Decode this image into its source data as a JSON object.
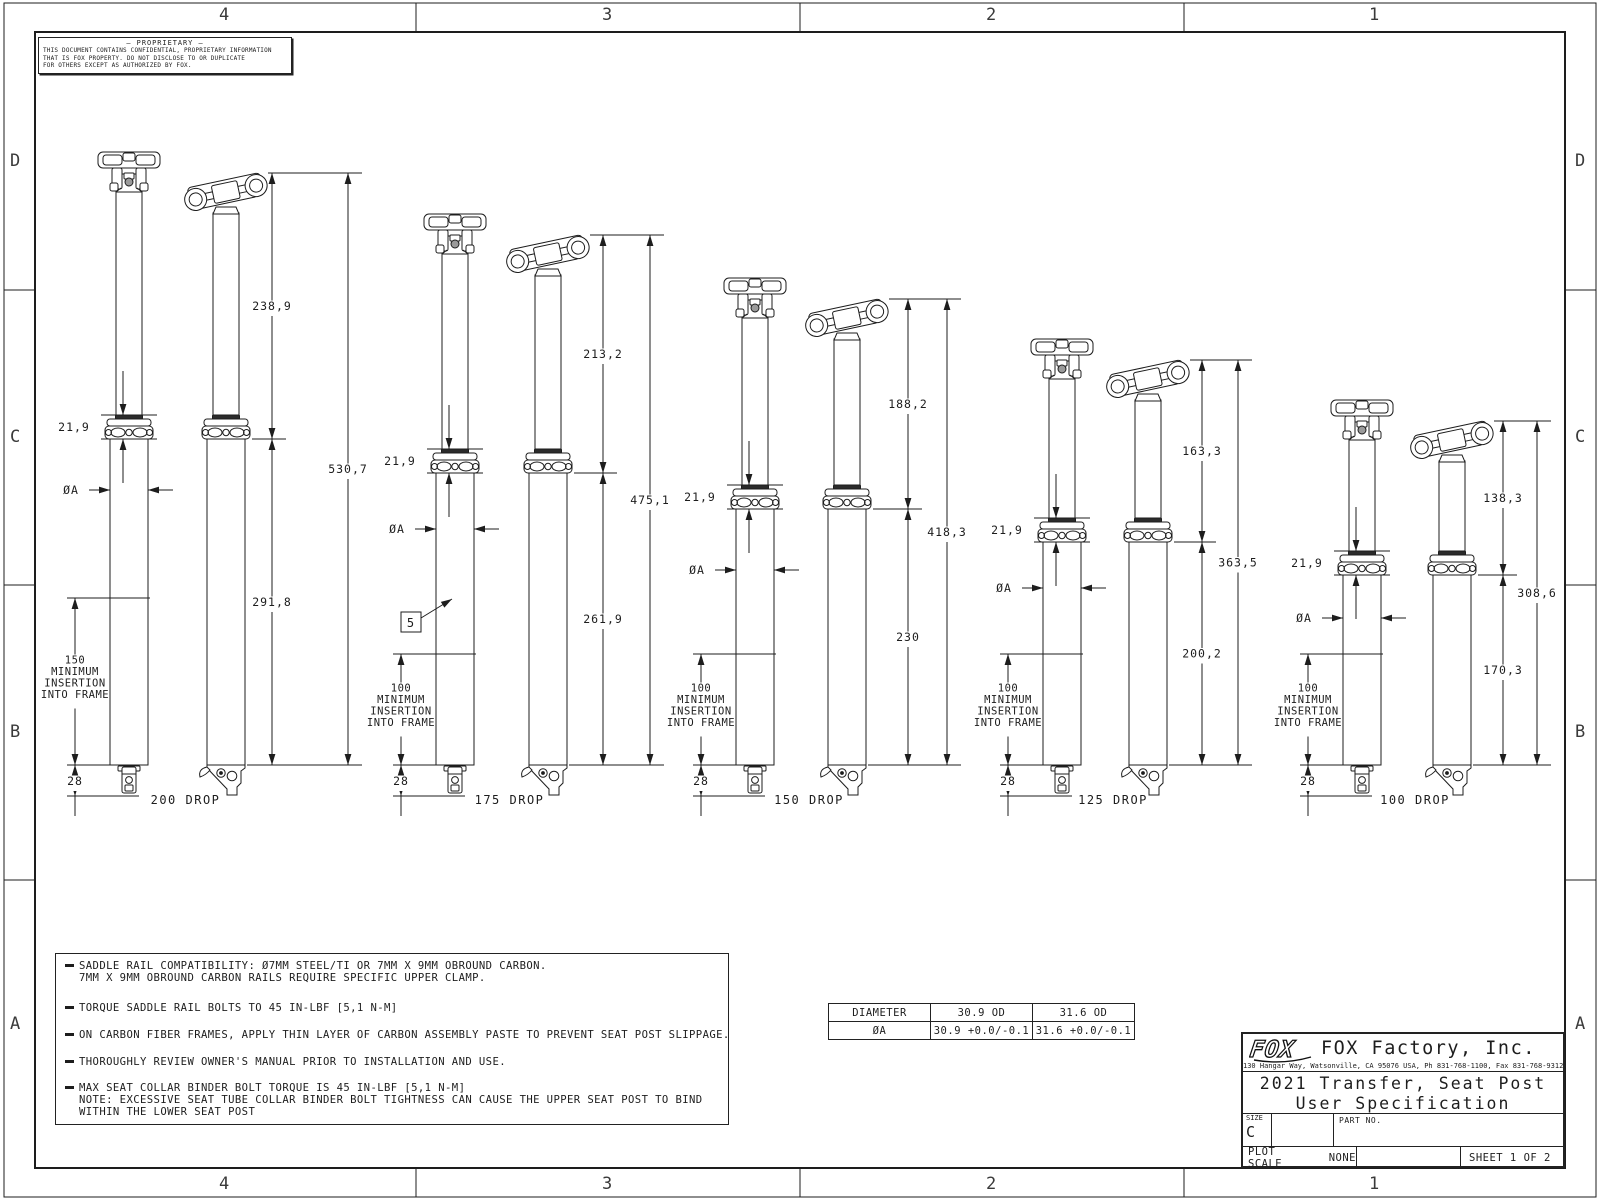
{
  "colors": {
    "line": "#1d1d1d",
    "background": "#ffffff"
  },
  "sheet": {
    "zones_top": [
      "4",
      "3",
      "2",
      "1"
    ],
    "zones_bottom": [
      "4",
      "3",
      "2",
      "1"
    ],
    "zones_left": [
      "D",
      "C",
      "B",
      "A"
    ],
    "zones_right": [
      "D",
      "C",
      "B",
      "A"
    ]
  },
  "proprietary": {
    "title": "—  PROPRIETARY  —",
    "line1": "THIS DOCUMENT CONTAINS CONFIDENTIAL, PROPRIETARY INFORMATION",
    "line2": "THAT IS FOX PROPERTY.  DO NOT DISCLOSE TO OR DUPLICATE",
    "line3": "FOR OTHERS EXCEPT AS AUTHORIZED BY FOX."
  },
  "drawing": {
    "baseline_y": 765,
    "px_per_mm": 1.115,
    "variants": [
      {
        "drop_label": "200 DROP",
        "cx_front": 129,
        "cx_side": 226,
        "chain_x": 272,
        "overall_x": 348,
        "dia_y": 490,
        "upper_mm": 238.9,
        "lower_mm": 291.8,
        "overall_mm": 530.7,
        "collar_mm": 21.9,
        "insertion_mm": 150,
        "foot_mm": 28,
        "upper_label": "238,9",
        "lower_label": "291,8",
        "overall_label": "530,7",
        "collar_label": "21,9",
        "foot_label": "28",
        "dia_label": "ØA",
        "insertion_note": [
          "150",
          "MINIMUM",
          "INSERTION",
          "INTO FRAME"
        ]
      },
      {
        "drop_label": "175 DROP",
        "cx_front": 455,
        "cx_side": 548,
        "chain_x": 603,
        "overall_x": 650,
        "dia_y": 529,
        "upper_mm": 213.2,
        "lower_mm": 261.9,
        "overall_mm": 475.1,
        "collar_mm": 21.9,
        "insertion_mm": 100,
        "foot_mm": 28,
        "upper_label": "213,2",
        "lower_label": "261,9",
        "overall_label": "475,1",
        "collar_label": "21,9",
        "foot_label": "28",
        "dia_label": "ØA",
        "insertion_note": [
          "100",
          "MINIMUM",
          "INSERTION",
          "INTO FRAME"
        ],
        "flag": {
          "text": "5",
          "x": 401,
          "y": 612,
          "tip_x": 452,
          "tip_y": 599
        }
      },
      {
        "drop_label": "150 DROP",
        "cx_front": 755,
        "cx_side": 847,
        "chain_x": 908,
        "overall_x": 947,
        "dia_y": 570,
        "upper_mm": 188.2,
        "lower_mm": 230,
        "overall_mm": 418.3,
        "collar_mm": 21.9,
        "insertion_mm": 100,
        "foot_mm": 28,
        "upper_label": "188,2",
        "lower_label": "230",
        "overall_label": "418,3",
        "collar_label": "21,9",
        "foot_label": "28",
        "dia_label": "ØA",
        "insertion_note": [
          "100",
          "MINIMUM",
          "INSERTION",
          "INTO FRAME"
        ]
      },
      {
        "drop_label": "125 DROP",
        "cx_front": 1062,
        "cx_side": 1148,
        "chain_x": 1202,
        "overall_x": 1238,
        "dia_y": 588,
        "upper_mm": 163.3,
        "lower_mm": 200.2,
        "overall_mm": 363.5,
        "collar_mm": 21.9,
        "insertion_mm": 100,
        "foot_mm": 28,
        "upper_label": "163,3",
        "lower_label": "200,2",
        "overall_label": "363,5",
        "collar_label": "21,9",
        "foot_label": "28",
        "dia_label": "ØA",
        "insertion_note": [
          "100",
          "MINIMUM",
          "INSERTION",
          "INTO FRAME"
        ]
      },
      {
        "drop_label": "100 DROP",
        "cx_front": 1362,
        "cx_side": 1452,
        "chain_x": 1503,
        "overall_x": 1537,
        "dia_y": 618,
        "upper_mm": 138.3,
        "lower_mm": 170.3,
        "overall_mm": 308.6,
        "collar_mm": 21.9,
        "insertion_mm": 100,
        "foot_mm": 28,
        "upper_label": "138,3",
        "lower_label": "170,3",
        "overall_label": "308,6",
        "collar_label": "21,9",
        "foot_label": "28",
        "dia_label": "ØA",
        "insertion_note": [
          "100",
          "MINIMUM",
          "INSERTION",
          "INTO FRAME"
        ]
      }
    ]
  },
  "notes": {
    "items": [
      {
        "lines": [
          "SADDLE RAIL COMPATIBILITY: Ø7MM STEEL/TI OR 7MM X 9MM OBROUND CARBON.",
          "7MM X 9MM OBROUND CARBON RAILS REQUIRE SPECIFIC UPPER CLAMP."
        ]
      },
      {
        "lines": [
          "TORQUE SADDLE RAIL BOLTS TO 45 IN-LBF [5,1 N-M]"
        ]
      },
      {
        "lines": [
          "ON CARBON FIBER FRAMES, APPLY THIN LAYER OF CARBON ASSEMBLY PASTE TO PREVENT SEAT POST SLIPPAGE."
        ]
      },
      {
        "lines": [
          "THOROUGHLY REVIEW OWNER'S MANUAL PRIOR TO INSTALLATION AND USE."
        ]
      },
      {
        "lines": [
          "MAX SEAT COLLAR BINDER BOLT TORQUE IS 45 IN-LBF [5,1 N-M]",
          "NOTE: EXCESSIVE SEAT TUBE COLLAR BINDER BOLT TIGHTNESS CAN CAUSE THE UPPER SEAT POST TO BIND",
          "WITHIN THE LOWER SEAT POST"
        ]
      }
    ]
  },
  "diameter_table": {
    "header_row": [
      "DIAMETER",
      "30.9 OD",
      "31.6 OD"
    ],
    "value_row": [
      "ØA",
      "30.9 +0.0/-0.1",
      "31.6 +0.0/-0.1"
    ]
  },
  "title_block": {
    "logo_text": "FOX",
    "company": "FOX Factory, Inc.",
    "address": "130 Hangar Way, Watsonville, CA 95076 USA, Ph 831-768-1100, Fax 831-768-9312",
    "title_line1": "2021 Transfer, Seat Post",
    "title_line2": "User Specification",
    "size_label": "SIZE",
    "size_value": "C",
    "part_no_label": "PART NO.",
    "plot_scale_label": "PLOT SCALE",
    "plot_scale_value": "NONE",
    "sheet_label": "SHEET 1 OF 2"
  }
}
